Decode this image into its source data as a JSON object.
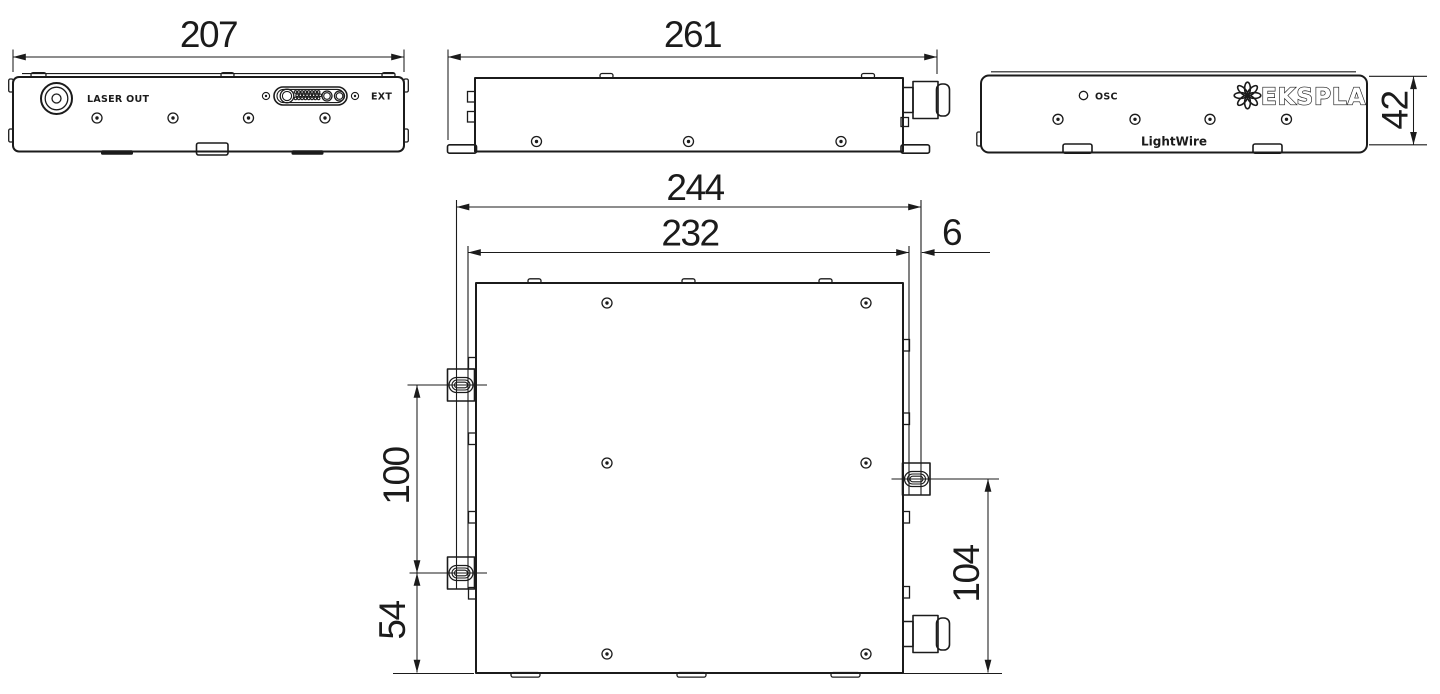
{
  "colors": {
    "line": "#1b1b1b",
    "background": "#ffffff"
  },
  "views": {
    "front": {
      "dim_width": "207",
      "laser_out": "LASER OUT",
      "ext": "EXT"
    },
    "side": {
      "dim_length": "261"
    },
    "back": {
      "dim_height": "42",
      "osc": "OSC",
      "brand": "EKSPLA",
      "model": "LightWire"
    },
    "top": {
      "dim_overall_width": "244",
      "dim_body_width": "232",
      "dim_gland_offset": "6",
      "dim_slot_spacing": "100",
      "dim_slot_to_front": "54",
      "dim_right_slot_to_front": "104"
    }
  }
}
